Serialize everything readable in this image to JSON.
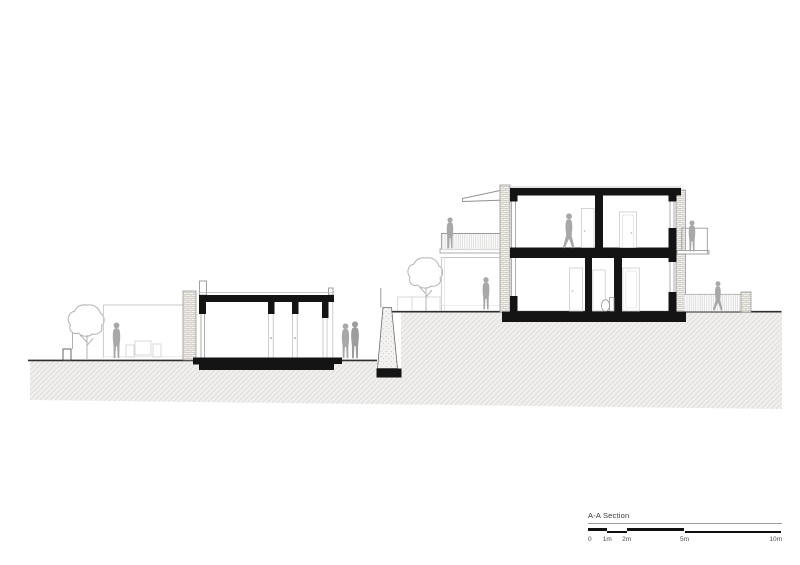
{
  "scale_bar": {
    "title": "A-A Section",
    "tick_labels": [
      "0",
      "1m",
      "2m",
      "5m",
      "10m"
    ]
  },
  "colors": {
    "paper": "#ffffff",
    "ink": "#141414",
    "ground_line": "#2e2e2e",
    "earth_fill": "#f0efed",
    "earth_hatch_line": "#d8d6d2",
    "silhouette_gray": "#a8a8a8",
    "elevation_line": "#c6c6c6",
    "brick_line": "#b9b4ab",
    "label_text": "#4a4a4a"
  },
  "icons": {
    "person_standing": "person-silhouette-standing",
    "person_walking": "person-silhouette-walking",
    "tree": "tree-icon"
  }
}
